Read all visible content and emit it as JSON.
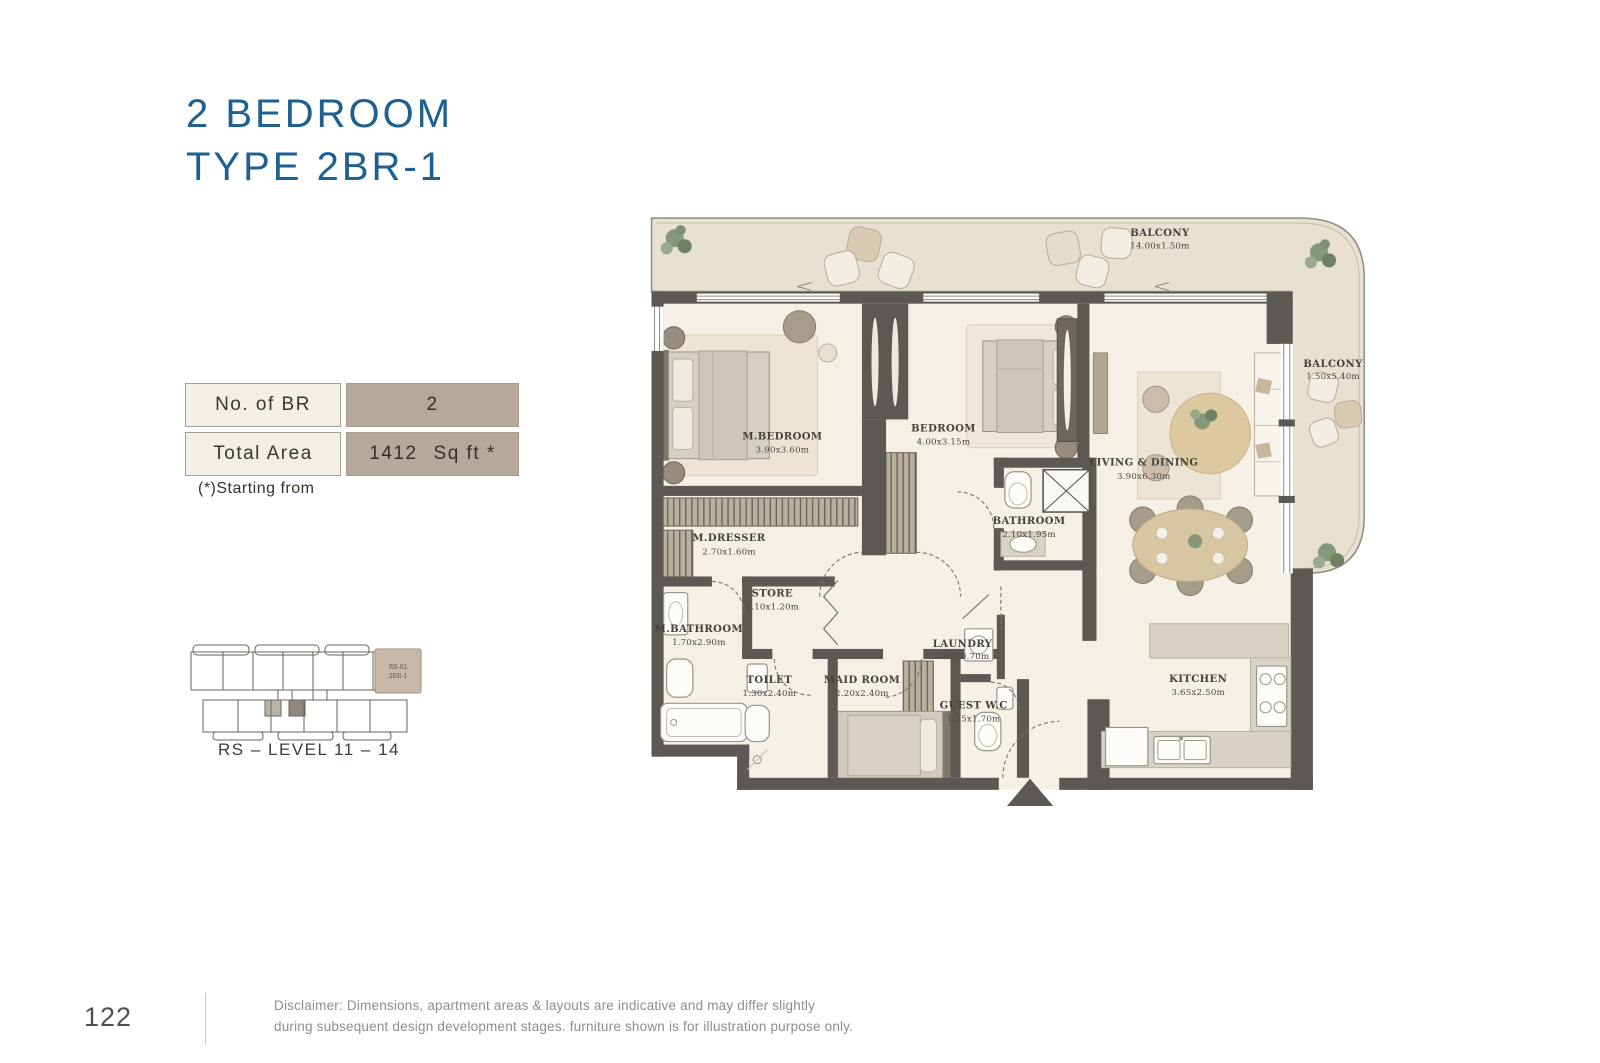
{
  "page": {
    "title_line1": "2 BEDROOM",
    "title_line2": "TYPE 2BR-1",
    "page_number": "122",
    "disclaimer_line1": "Disclaimer: Dimensions, apartment areas & layouts are indicative and may differ slightly",
    "disclaimer_line2": "during subsequent design development stages. furniture shown is for illustration purpose only."
  },
  "info_table": {
    "rows": [
      {
        "label": "No. of BR",
        "value": "2",
        "unit": ""
      },
      {
        "label": "Total Area",
        "value": "1412",
        "unit": "Sq ft *"
      }
    ],
    "note": "(*)Starting from"
  },
  "key_plan": {
    "unit_label_line1": "RS-02",
    "unit_label_line2": "2BR-1",
    "caption": "RS – LEVEL 11 – 14"
  },
  "plan": {
    "rooms": [
      {
        "name": "BALCONY",
        "dims": "14.00x1.50m"
      },
      {
        "name": "BALCONY",
        "dims": "1.50x5.40m"
      },
      {
        "name": "M.BEDROOM",
        "dims": "3.90x3.60m"
      },
      {
        "name": "BEDROOM",
        "dims": "4.00x3.15m"
      },
      {
        "name": "BATHROOM",
        "dims": "2.10x1.95m"
      },
      {
        "name": "LIVING & DINING",
        "dims": "3.90x6.30m"
      },
      {
        "name": "M.DRESSER",
        "dims": "2.70x1.60m"
      },
      {
        "name": "STORE",
        "dims": "1.10x1.20m"
      },
      {
        "name": "M.BATHROOM",
        "dims": "1.70x2.90m"
      },
      {
        "name": "TOILET",
        "dims": "1.30x2.40m"
      },
      {
        "name": "MAID ROOM",
        "dims": "2.20x2.40m"
      },
      {
        "name": "LAUNDRY",
        "dims": "1.00x0.70m"
      },
      {
        "name": "GUEST W.C",
        "dims": "1.25x1.70m"
      },
      {
        "name": "KITCHEN",
        "dims": "3.65x2.50m"
      }
    ]
  },
  "colors": {
    "title_blue": "#1e6090",
    "wall": "#5c5955",
    "floor": "#f4f0e6",
    "balcony_floor": "#e8e1d2",
    "table_label_bg": "#f2efe7",
    "table_value_bg": "#b6a89a",
    "keyplan_highlight": "#c9b8a8",
    "plant_green": "#87977a"
  }
}
